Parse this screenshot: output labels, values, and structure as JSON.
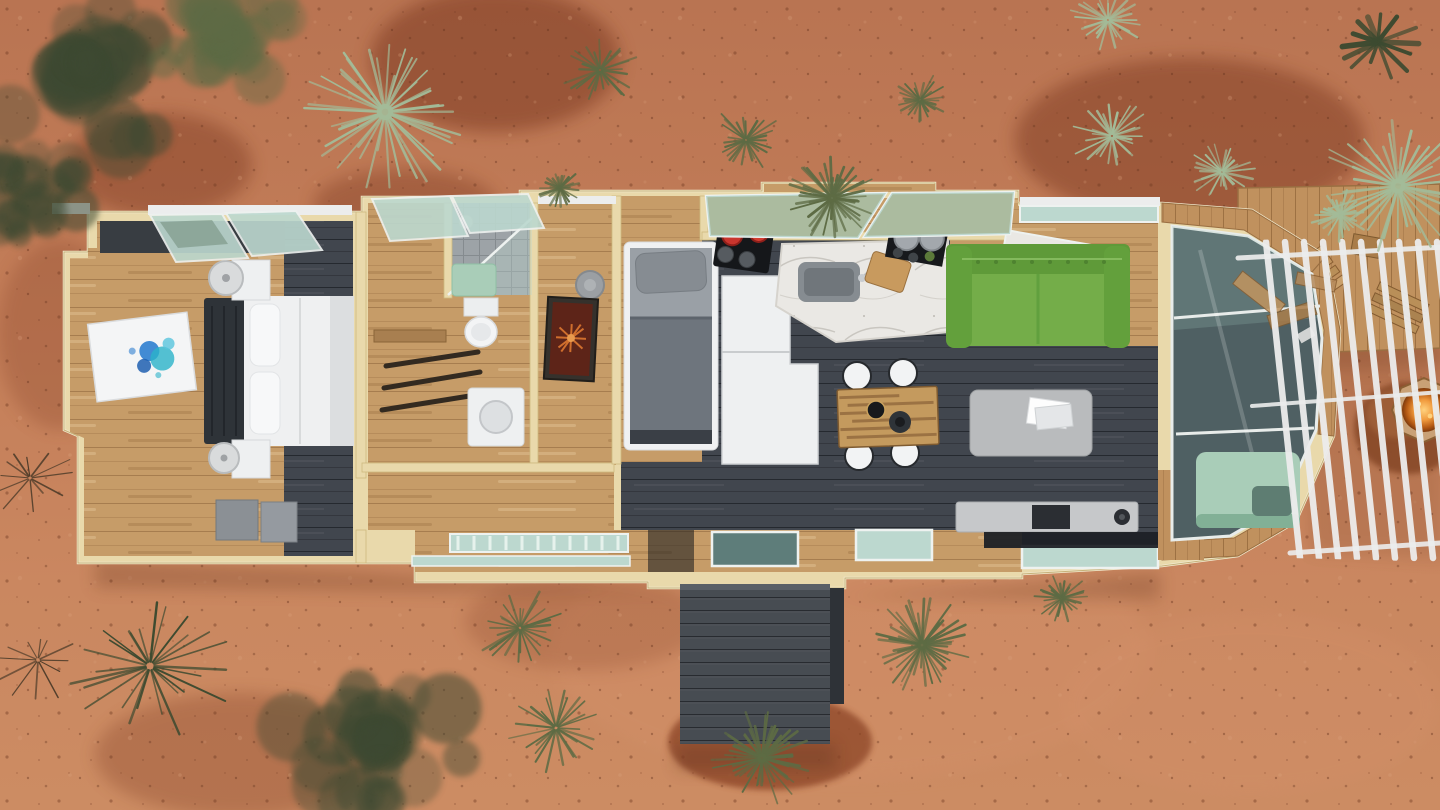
{
  "scene": {
    "kind": "aerial 3D dollhouse rendering",
    "subject": "modular tiny home floor plan, roof removed",
    "setting": "red desert ground with scattered yucca, agave and dry brush",
    "view": "top-down"
  },
  "palette": {
    "ground": "#c17c57",
    "ground_light": "#d4977311",
    "gravel": "#7e3b24",
    "wall": "#e9d9ab",
    "wall_edge": "#c6b179",
    "trim_white": "#eceded",
    "wood": "#c69c68",
    "wood_dark": "#a87f50",
    "deck_wood": "#c0915e",
    "charcoal": "#41464e",
    "charcoal_dark": "#32373e",
    "white_furn": "#eef0f1",
    "glass_teal": "#bcd8cf",
    "glass_dark": "#4f6063",
    "mint": "#a9cdb8",
    "sofa_green": "#74ad49",
    "sofa_green_dark": "#5f9a39",
    "red_pot": "#c9352e",
    "fire_glow": "#f19b3e",
    "rock_brown": "#8a4c2c",
    "steel_gray": "#8b9095",
    "table_gray": "#b9bbbd",
    "art_blue": "#2f7fd0",
    "art_cyan": "#2bb3c9",
    "art_orange": "#cf6e2d",
    "oxblood": "#5d2418",
    "plant_dark": "#3c4a30",
    "plant_olive": "#5d6b44",
    "plant_sage": "#a3bb98",
    "plant_twig": "#4a3a28"
  },
  "floor_plan": {
    "rooms": [
      {
        "id": "bedroom",
        "label": "main bedroom"
      },
      {
        "id": "wardrobe",
        "label": "wardrobe and shower room"
      },
      {
        "id": "hall-nook",
        "label": "hall nook"
      },
      {
        "id": "bunk-room",
        "label": "single-bed room"
      },
      {
        "id": "kitchen",
        "label": "kitchen"
      },
      {
        "id": "dining-area",
        "label": "dining area"
      },
      {
        "id": "living-room",
        "label": "living room"
      },
      {
        "id": "sunroom",
        "label": "glass-roofed sunroom"
      },
      {
        "id": "entry-porch",
        "label": "charcoal entry steps"
      },
      {
        "id": "side-deck",
        "label": "pergola deck with fire pit"
      }
    ],
    "furniture": [
      {
        "room": "bedroom",
        "item": "double bed, white duvet, dark tufted headboard"
      },
      {
        "room": "bedroom",
        "item": "two white nightstands with round lamps"
      },
      {
        "room": "bedroom",
        "item": "floor canvas with blue paint splash"
      },
      {
        "room": "bedroom",
        "item": "two blue-gray storage chests"
      },
      {
        "room": "wardrobe",
        "item": "three hanging rails"
      },
      {
        "room": "wardrobe",
        "item": "walk-in shower with glass panel and mint bench"
      },
      {
        "room": "wardrobe",
        "item": "toilet"
      },
      {
        "room": "wardrobe",
        "item": "compact washer cabinet"
      },
      {
        "room": "hall-nook",
        "item": "round ceiling light"
      },
      {
        "room": "hall-nook",
        "item": "leaning artwork with orange starburst"
      },
      {
        "room": "bunk-room",
        "item": "single bed, gray bedding, white frame"
      },
      {
        "room": "kitchen",
        "item": "black cooktop with two red pots"
      },
      {
        "room": "kitchen",
        "item": "tall white fridge cabinet"
      },
      {
        "room": "kitchen",
        "item": "marble island with sink and cutting board"
      },
      {
        "room": "kitchen",
        "item": "black shelf with gray canisters"
      },
      {
        "room": "dining-area",
        "item": "butcher-block table with four white chairs"
      },
      {
        "room": "dining-area",
        "item": "black bowl and dark vase"
      },
      {
        "room": "living-room",
        "item": "green tufted sofa"
      },
      {
        "room": "living-room",
        "item": "light gray coffee table with magazines"
      },
      {
        "room": "living-room",
        "item": "long media console with turntable"
      },
      {
        "room": "sunroom",
        "item": "mint daybed under angled glass"
      },
      {
        "room": "sunroom",
        "item": "wooden lounge chairs seen through glass"
      },
      {
        "room": "side-deck",
        "item": "white slatted pergola"
      },
      {
        "room": "side-deck",
        "item": "octagonal fire pit on rock mound"
      }
    ]
  },
  "environment": {
    "ground": "red desert soil with dark gravel patches and speckled stones",
    "pergola": {
      "slats": 10
    },
    "plants": [
      {
        "type": "shrub",
        "x": 95,
        "y": 75,
        "r": 115,
        "color": "plant_dark"
      },
      {
        "type": "shrub",
        "x": 235,
        "y": 45,
        "r": 85,
        "color": "plant_olive"
      },
      {
        "type": "shrub",
        "x": 35,
        "y": 195,
        "r": 70,
        "color": "plant_dark"
      },
      {
        "type": "yucca",
        "x": 385,
        "y": 112,
        "r": 90,
        "color": "plant_sage"
      },
      {
        "type": "grass",
        "x": 600,
        "y": 70,
        "r": 40,
        "color": "plant_olive"
      },
      {
        "type": "grass",
        "x": 746,
        "y": 140,
        "r": 38,
        "color": "plant_olive"
      },
      {
        "type": "grass",
        "x": 920,
        "y": 100,
        "r": 30,
        "color": "plant_olive"
      },
      {
        "type": "grass",
        "x": 1108,
        "y": 20,
        "r": 40,
        "color": "plant_sage"
      },
      {
        "type": "grass",
        "x": 1112,
        "y": 136,
        "r": 42,
        "color": "plant_sage"
      },
      {
        "type": "grass",
        "x": 1222,
        "y": 172,
        "r": 34,
        "color": "plant_sage"
      },
      {
        "type": "agave",
        "x": 1378,
        "y": 42,
        "r": 52,
        "color": "plant_dark"
      },
      {
        "type": "yucca",
        "x": 1398,
        "y": 186,
        "r": 82,
        "color": "plant_sage"
      },
      {
        "type": "grass",
        "x": 150,
        "y": 666,
        "r": 90,
        "color": "plant_dark"
      },
      {
        "type": "shrub",
        "x": 380,
        "y": 738,
        "r": 105,
        "color": "plant_dark"
      },
      {
        "type": "twigs",
        "x": 30,
        "y": 478,
        "r": 45,
        "color": "plant_twig"
      },
      {
        "type": "twigs",
        "x": 38,
        "y": 660,
        "r": 48,
        "color": "plant_twig"
      },
      {
        "type": "grass",
        "x": 520,
        "y": 628,
        "r": 46,
        "color": "plant_olive"
      },
      {
        "type": "grass",
        "x": 556,
        "y": 728,
        "r": 50,
        "color": "plant_olive"
      },
      {
        "type": "yucca",
        "x": 762,
        "y": 758,
        "r": 54,
        "color": "plant_olive"
      },
      {
        "type": "yucca",
        "x": 922,
        "y": 645,
        "r": 54,
        "color": "plant_olive"
      },
      {
        "type": "grass",
        "x": 1062,
        "y": 598,
        "r": 28,
        "color": "plant_olive"
      },
      {
        "type": "yucca",
        "x": 832,
        "y": 198,
        "r": 46,
        "color": "plant_olive"
      },
      {
        "type": "grass",
        "x": 560,
        "y": 188,
        "r": 22,
        "color": "plant_olive"
      },
      {
        "type": "grass",
        "x": 1340,
        "y": 215,
        "r": 30,
        "color": "plant_sage"
      }
    ]
  }
}
